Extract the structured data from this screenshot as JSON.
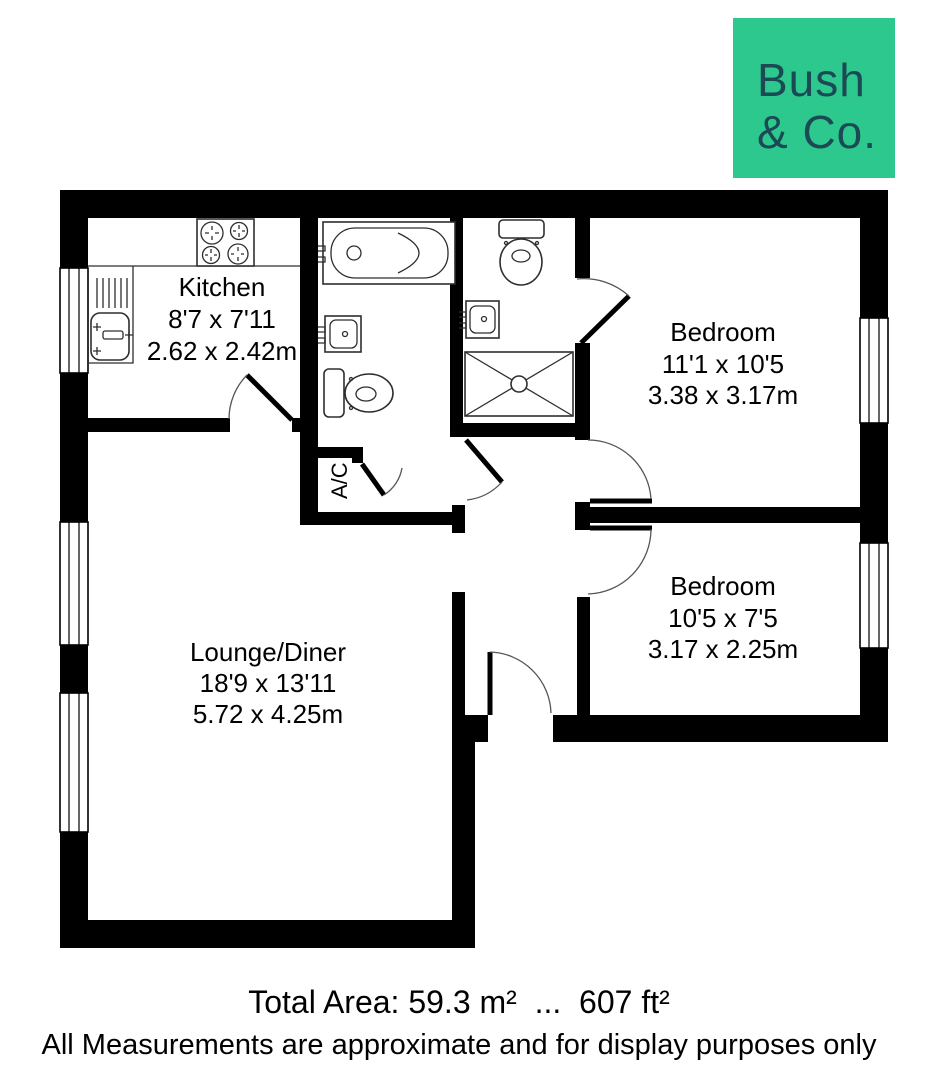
{
  "logo": {
    "line1": "Bush",
    "line2": "& Co.",
    "bg_color": "#2CC88E",
    "text_color": "#1B4A55"
  },
  "rooms": {
    "kitchen": {
      "name": "Kitchen",
      "imperial": "8'7 x 7'11",
      "metric": "2.62 x 2.42m"
    },
    "bedroom1": {
      "name": "Bedroom",
      "imperial": "11'1 x 10'5",
      "metric": "3.38 x 3.17m"
    },
    "bedroom2": {
      "name": "Bedroom",
      "imperial": "10'5 x 7'5",
      "metric": "3.17 x 2.25m"
    },
    "lounge": {
      "name": "Lounge/Diner",
      "imperial": "18'9 x 13'11",
      "metric": "5.72 x 4.25m"
    },
    "ac_closet": {
      "label": "A/C"
    }
  },
  "footer": {
    "total_area": "Total Area: 59.3 m²  ...  607 ft²",
    "disclaimer": "All Measurements are approximate and for display purposes only"
  }
}
